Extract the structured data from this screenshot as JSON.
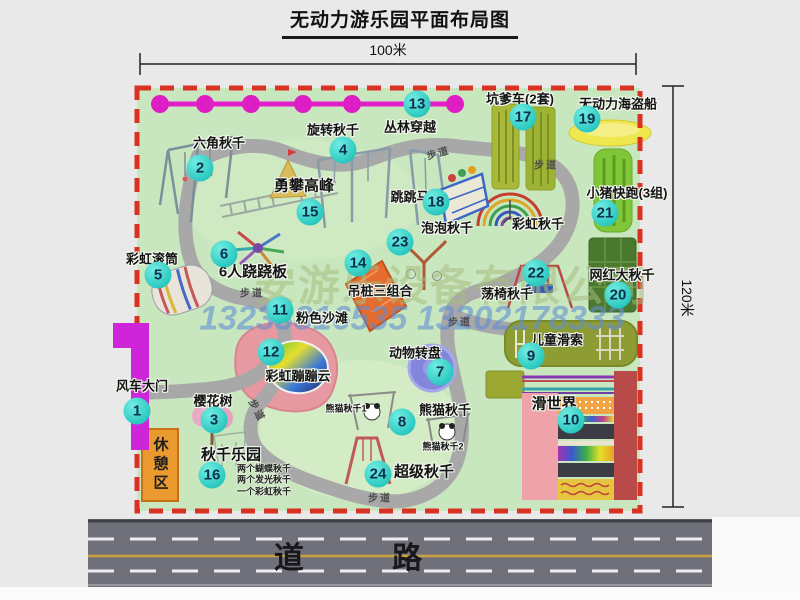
{
  "title": "无动力游乐园平面布局图",
  "dimensions": {
    "width": "100米",
    "height": "120米"
  },
  "road_label": "道 路",
  "trail_label": "步道",
  "rest_area_label": "休憩区",
  "watermark": {
    "company": "安游乐设备有限公司",
    "phone": "13233816535 13202178333"
  },
  "unnumbered": {
    "rainbow_swing": "彩虹秋千",
    "panda_swing_1": "熊猫秋千1",
    "panda_swing_2": "熊猫秋千2"
  },
  "swing_park_notes": [
    "两个蝴蝶秋千",
    "两个发光秋千",
    "一个彩虹秋千"
  ],
  "attractions": {
    "a1": {
      "num": "1",
      "label": "风车大门"
    },
    "a2": {
      "num": "2",
      "label": "六角秋千"
    },
    "a3": {
      "num": "3",
      "label": "樱花树"
    },
    "a4": {
      "num": "4",
      "label": "旋转秋千"
    },
    "a5": {
      "num": "5",
      "label": "彩虹滚筒"
    },
    "a6": {
      "num": "6",
      "label": "6人跷跷板"
    },
    "a7": {
      "num": "7",
      "label": "动物转盘"
    },
    "a8": {
      "num": "8",
      "label": "熊猫秋千"
    },
    "a9": {
      "num": "9",
      "label": "儿童滑索"
    },
    "a10": {
      "num": "10",
      "label": "滑世界"
    },
    "a11": {
      "num": "11",
      "label": "粉色沙滩"
    },
    "a12": {
      "num": "12",
      "label": "彩虹蹦蹦云"
    },
    "a13": {
      "num": "13",
      "label": "丛林穿越"
    },
    "a14": {
      "num": "14",
      "label": "吊桩三组合"
    },
    "a15": {
      "num": "15",
      "label": "勇攀高峰"
    },
    "a16": {
      "num": "16",
      "label": "秋千乐园"
    },
    "a17": {
      "num": "17",
      "label": "坑爹车(2套)"
    },
    "a18": {
      "num": "18",
      "label": "跳跳马"
    },
    "a19": {
      "num": "19",
      "label": "无动力海盗船"
    },
    "a20": {
      "num": "20",
      "label": "网红大秋千"
    },
    "a21": {
      "num": "21",
      "label": "小猪快跑(3组)"
    },
    "a22": {
      "num": "22",
      "label": "荡椅秋千"
    },
    "a23": {
      "num": "23",
      "label": "泡泡秋千"
    },
    "a24": {
      "num": "24",
      "label": "超级秋千"
    }
  },
  "colors": {
    "park_green": "#c9e7bf",
    "boundary_red": "#d93222",
    "path_gray": "#a8a8a8",
    "zipline_magenta": "#e21cc9",
    "badge_teal": "#2cc9c0",
    "road_gray": "#70707a",
    "rest_area_orange": "#ea9a2e"
  }
}
